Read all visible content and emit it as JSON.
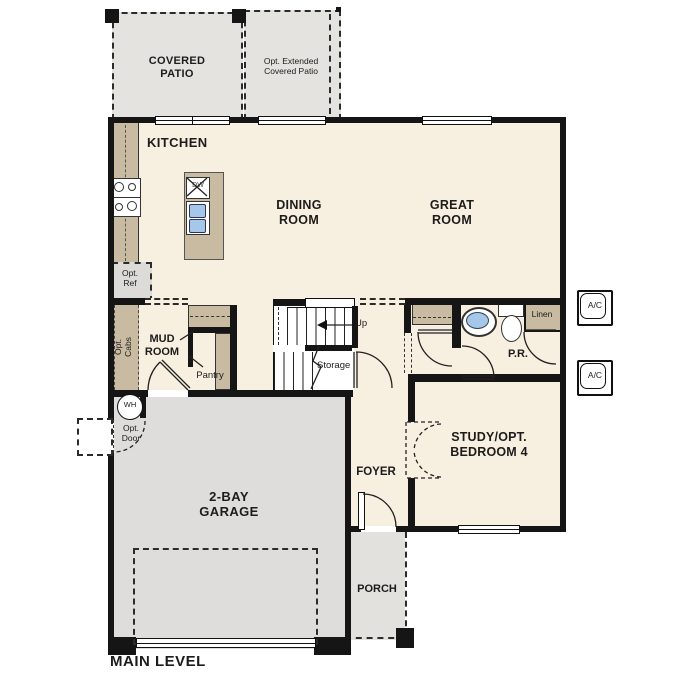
{
  "plan": {
    "title": "MAIN LEVEL",
    "labels": {
      "covered_patio": "COVERED\nPATIO",
      "extended_patio": "Opt. Extended\nCovered Patio",
      "kitchen": "KITCHEN",
      "dining_room": "DINING\nROOM",
      "great_room": "GREAT\nROOM",
      "opt_ref": "Opt.\nRef",
      "opt_cabs": "Opt.\nCabs",
      "mud_room": "MUD\nROOM",
      "pantry": "Pantry",
      "up": "Up",
      "storage": "Storage",
      "powder_room": "P.R.",
      "linen": "Linen",
      "study": "STUDY/OPT.\nBEDROOM 4",
      "foyer": "FOYER",
      "garage": "2-BAY\nGARAGE",
      "porch": "PORCH",
      "water_heater": "WH",
      "ac": "A/C",
      "dishwasher": "DW",
      "opt_door": "Opt.\nDoor"
    },
    "colors": {
      "floor_cream": "#f7efe0",
      "cabinet_tan": "#c9bba1",
      "patio_gray": "#e4e3df",
      "garage_gray": "#dedddb",
      "wall_black": "#151515",
      "sink_blue": "#a5c7e9"
    }
  }
}
